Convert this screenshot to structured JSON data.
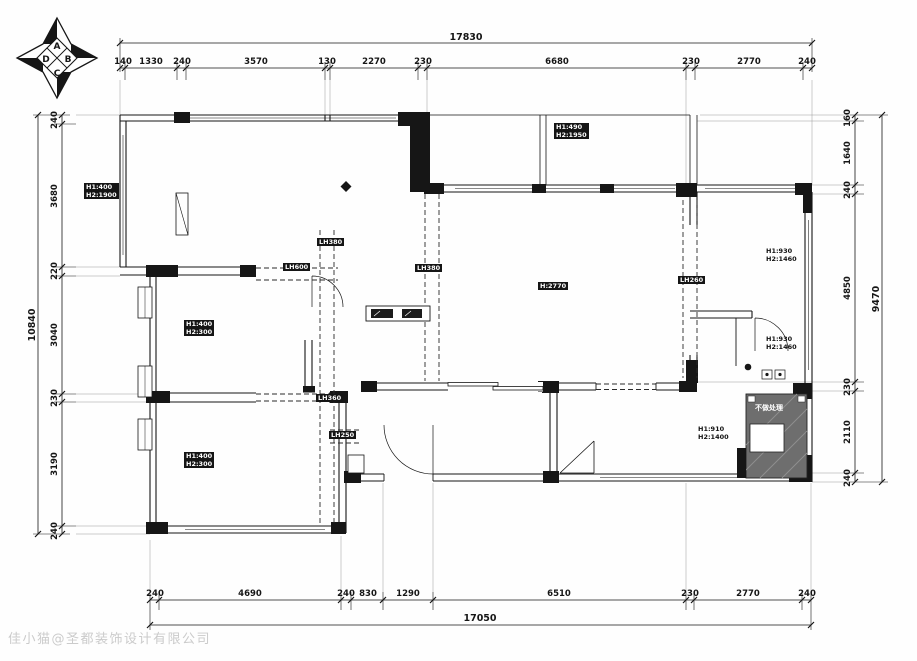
{
  "compass": {
    "top": "A",
    "right": "B",
    "bottom": "C",
    "left": "D"
  },
  "dims": {
    "top": {
      "total": "17830",
      "segments": [
        "140",
        "1330",
        "240",
        "3570",
        "130",
        "2270",
        "230",
        "6680",
        "230",
        "2770",
        "240"
      ]
    },
    "left": {
      "total": "10840",
      "segments": [
        "240",
        "3680",
        "220",
        "3040",
        "230",
        "3190",
        "240"
      ]
    },
    "right": {
      "total": "9470",
      "segments": [
        "160",
        "1640",
        "240",
        "4850",
        "230",
        "2110",
        "240"
      ]
    },
    "bottom": {
      "total": "17050",
      "segments": [
        "240",
        "4690",
        "240",
        "830",
        "1290",
        "6510",
        "230",
        "2770",
        "240"
      ]
    }
  },
  "labels": {
    "window_left": {
      "line1": "H1:400",
      "line2": "H2:1900"
    },
    "window_top": {
      "line1": "H1:490",
      "line2": "H2:1950"
    },
    "window_right_upper": {
      "line1": "H1:930",
      "line2": "H2:1460"
    },
    "window_right_lower": {
      "line1": "H1:930",
      "line2": "H2:1460"
    },
    "window_bottom": {
      "line1": "H1:910",
      "line2": "H2:1400"
    },
    "bay_left_upper": {
      "line1": "H1:400",
      "line2": "H2:300"
    },
    "bay_left_lower": {
      "line1": "H1:400",
      "line2": "H2:300"
    },
    "ceiling": "H:2770",
    "beams": [
      "LH380",
      "LH600",
      "LH380",
      "LH260",
      "LH360",
      "LH250"
    ],
    "hatch": "不做处理"
  },
  "watermark": "佳小猫@圣都装饰设计有限公司",
  "colors": {
    "line": "#161616",
    "hatch": "#6e6e6e",
    "watermark": "#cbcbcb"
  }
}
